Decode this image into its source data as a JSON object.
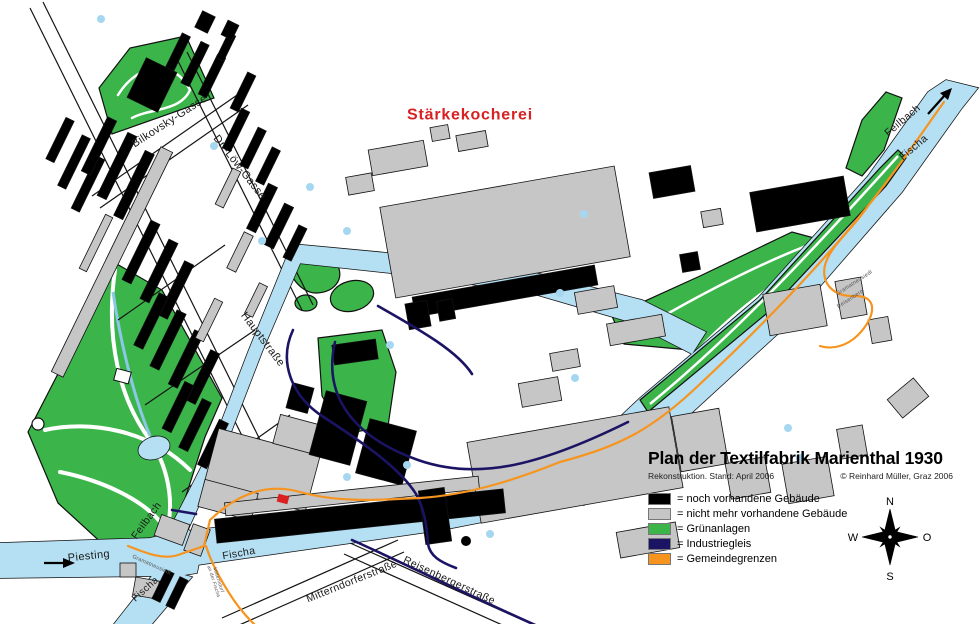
{
  "map": {
    "red_area_label": "Stärkekocherei",
    "streets": {
      "bilkovsky_gasse": "Bilkovsky-Gasse",
      "dr_loew_gasse": "Dr.-Löw-Gasse",
      "hauptstrasse": "Hauptstraße",
      "mitterndorferstrasse": "Mitterndorferstraße",
      "reisenbergerstrasse": "Reisenbergerstraße"
    },
    "waters": {
      "piesting": "Piesting",
      "feilbach_lower": "Feilbach",
      "fischa_middle": "Fischa",
      "fischa_branch": "Fischa",
      "feilbach_upper": "Feilbach",
      "fischa_upper": "Fischa"
    },
    "boundaries": {
      "gramatneusiedl_south": "Gramatneusiedl",
      "mitterndorf_line1": "Mitterndorf",
      "mitterndorf_line2": "an der Fischa",
      "gramatneusiedl_east": "Gramatneusiedl",
      "reisenberg_east": "Reisenberg"
    }
  },
  "legend": {
    "title": "Plan der Textilfabrik Marienthal 1930",
    "subtitle": "Rekonstruktion. Stand: April 2006",
    "copyright": "© Reinhard Müller, Graz 2006",
    "items": [
      {
        "color": "#000000",
        "label": "= noch vorhandene Gebäude"
      },
      {
        "color": "#C6C6C6",
        "label": "= nicht mehr vorhandene Gebäude"
      },
      {
        "color": "#3BB54A",
        "label": "= Grünanlagen"
      },
      {
        "color": "#1B1464",
        "label": "= Industriegleis"
      },
      {
        "color": "#F7941E",
        "label": "= Gemeindegrenzen"
      }
    ]
  },
  "compass": {
    "north": "N",
    "east": "O",
    "south": "S",
    "west": "W"
  },
  "colors": {
    "water": "#B5DFF2",
    "green": "#3BB54A",
    "building_existing": "#000000",
    "building_gone": "#C6C6C6",
    "rail": "#1B1464",
    "boundary": "#F7941E",
    "label_red": "#D92121"
  }
}
